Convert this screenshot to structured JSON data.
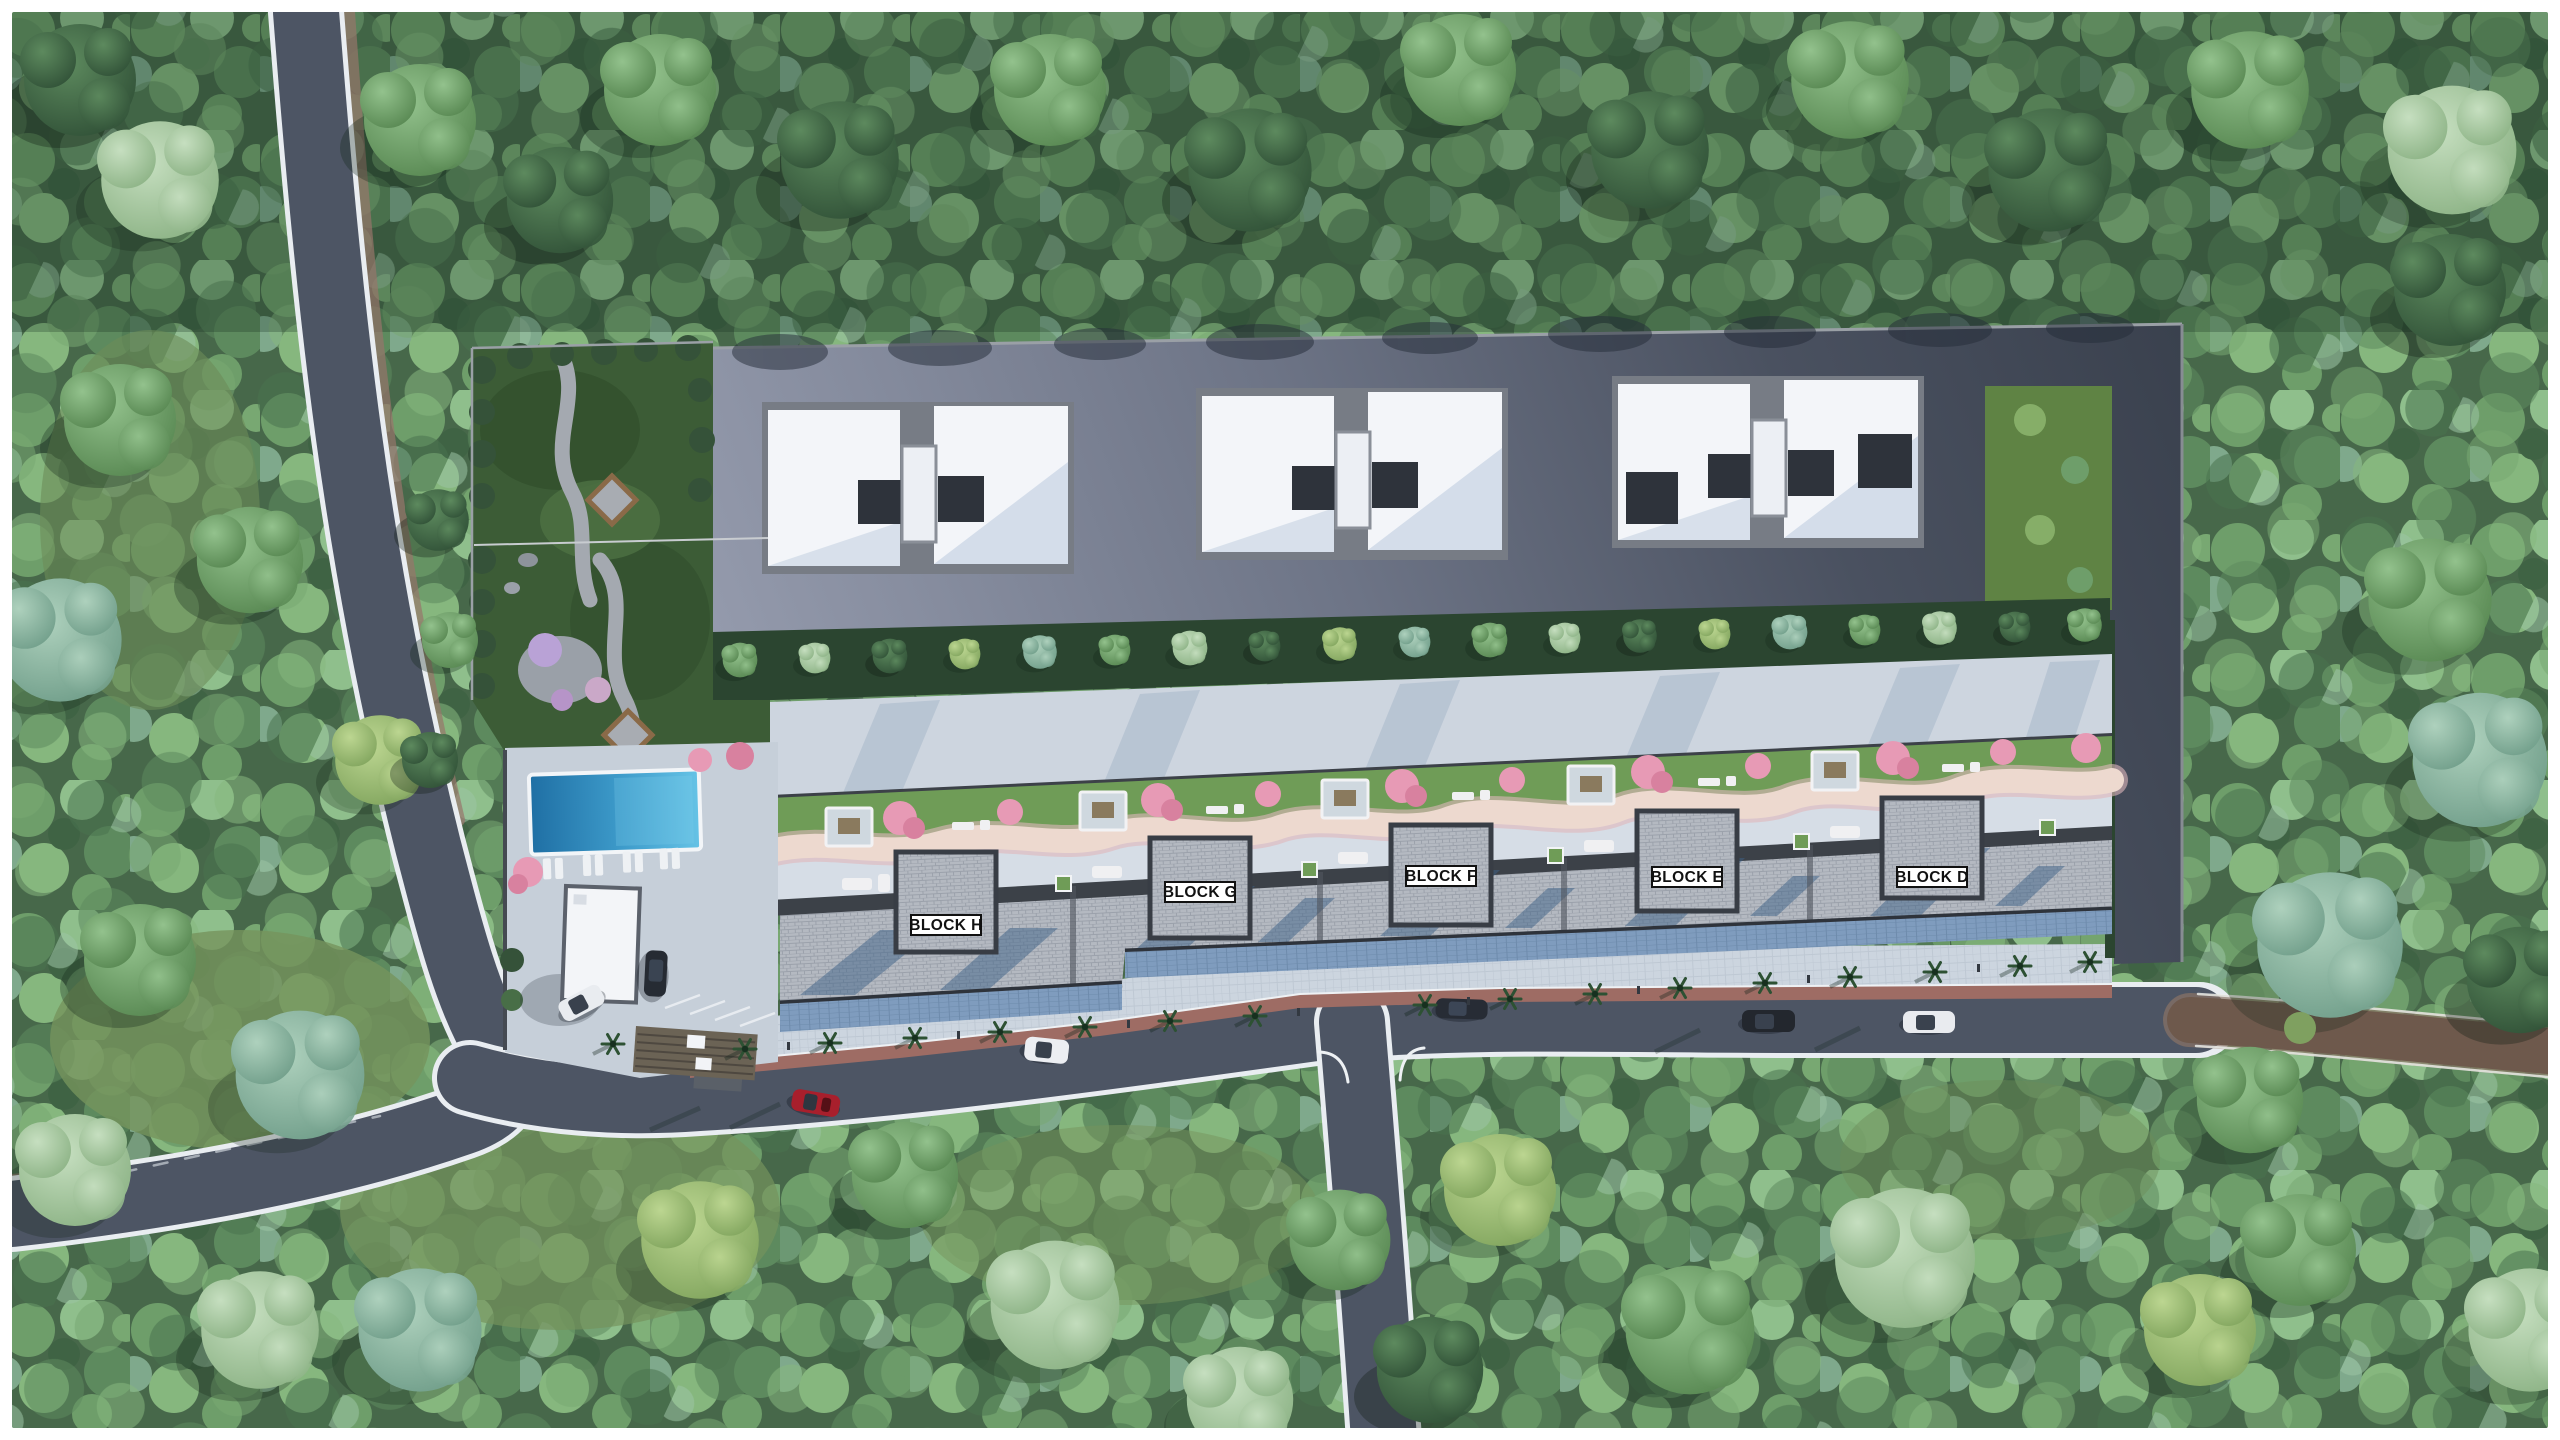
{
  "meta": {
    "type": "aerial-3d-site-plan",
    "description": "Bird's-eye 3D architectural rendering of a residential complex with five labeled blocks, rooftop amenity terrace, pool, gatehouse and surrounding forest"
  },
  "blocks": [
    {
      "id": "block-h",
      "label": "BLOCK H"
    },
    {
      "id": "block-g",
      "label": "BLOCK G"
    },
    {
      "id": "block-f",
      "label": "BLOCK F"
    },
    {
      "id": "block-e",
      "label": "BLOCK E"
    },
    {
      "id": "block-d",
      "label": "BLOCK D"
    }
  ],
  "palette": {
    "frame": "#ffffff",
    "forest": "#47684a",
    "road": "#4d5564",
    "asphalt": "#6d7486",
    "roof": "#b4b9c1",
    "roof_shadow": "#3e6288",
    "pool": "#3e9ccb",
    "terrace": "#d6dde6",
    "lawn": "#6f9c57",
    "walk_path": "#edd9cf",
    "sidewalk_pink": "#9e6c64",
    "dirt_road": "#6e594c",
    "label_bg": "#ffffff",
    "label_text": "#111111"
  }
}
